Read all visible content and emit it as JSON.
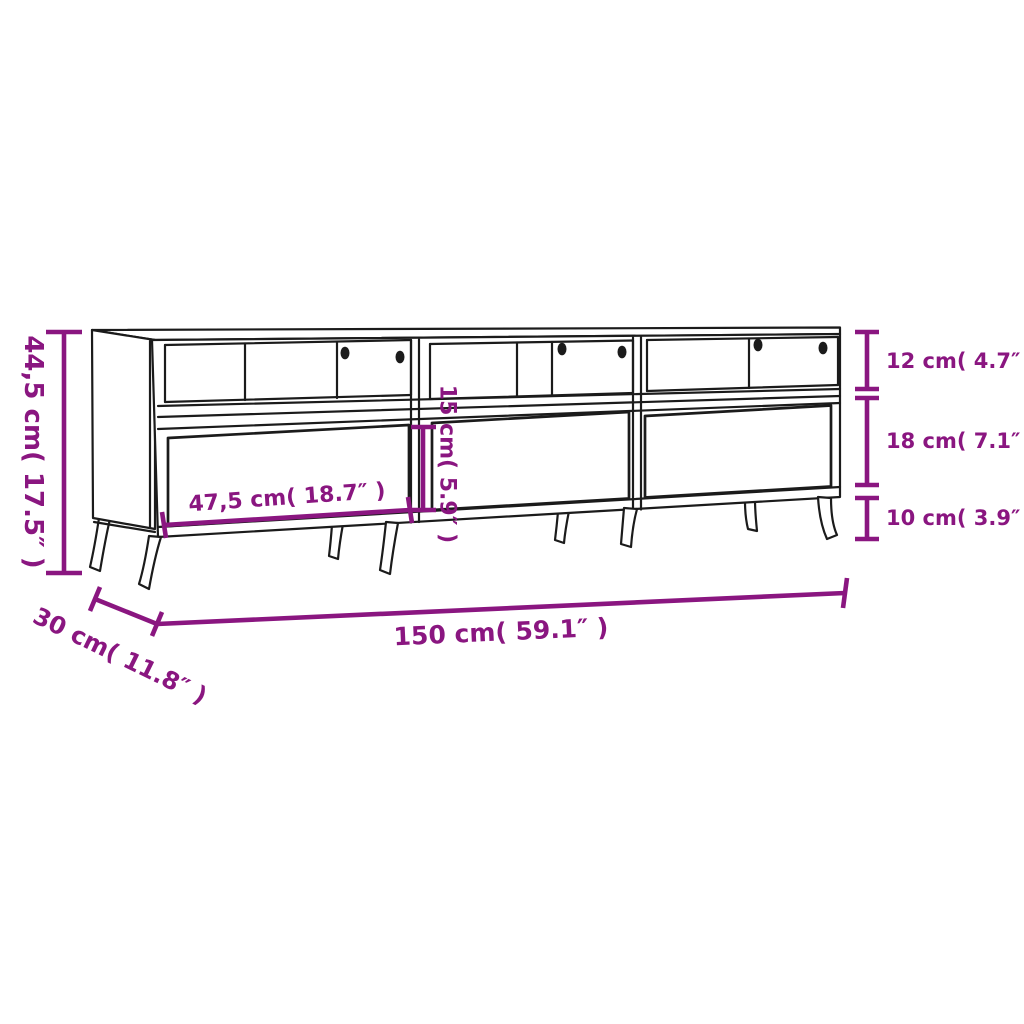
{
  "diagram": {
    "subject": "tv-stand-with-three-drawers",
    "colors": {
      "dimension": "#8A1680",
      "line": "#1b1b1b",
      "background": "#ffffff"
    },
    "dimensions": {
      "overall_height": "44,5 cm( 17.5″ )",
      "top_compartment_height": "12 cm( 4.7″ )",
      "drawer_front_height": "18 cm( 7.1″ )",
      "leg_height": "10 cm( 3.9″ )",
      "drawer_width": "47,5 cm( 18.7″ )",
      "drawer_height": "15 cm( 5.9″ )",
      "overall_width": "150 cm( 59.1″ )",
      "overall_depth": "30 cm( 11.8″ )"
    }
  }
}
